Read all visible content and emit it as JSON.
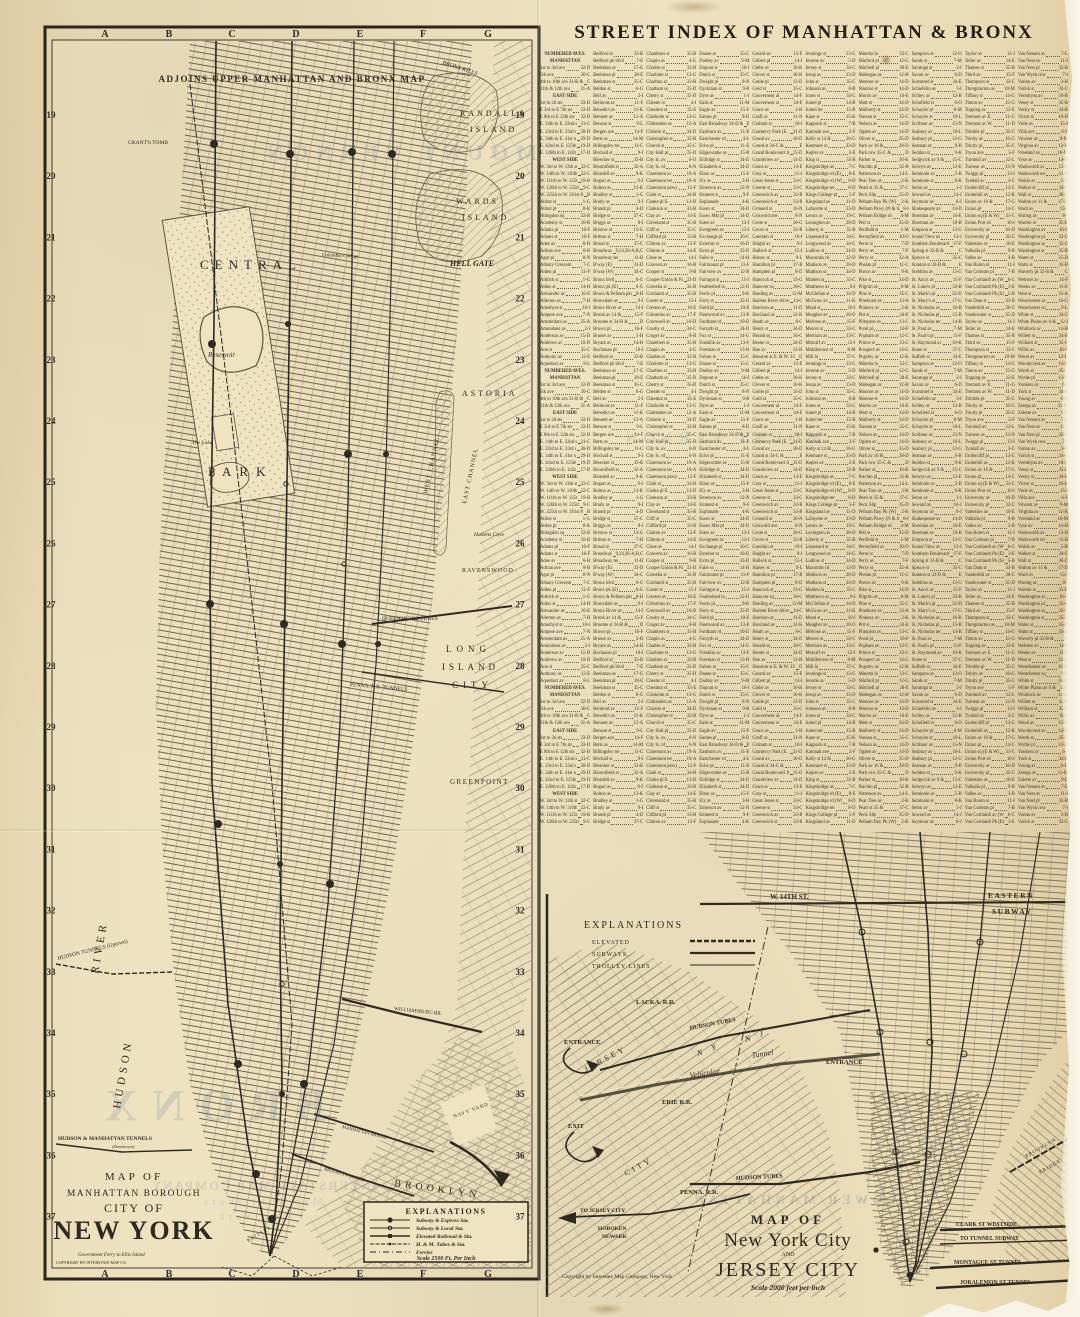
{
  "street_index": {
    "title": "STREET INDEX OF MANHATTAN & BRONX",
    "columns": [
      {
        "entries": [
          "*NUMBERED AVES.",
          "*MANHATTAN",
          "1st to 3rd avs 32-D",
          "5th ave 30-C",
          "4th to 10th avs 31-B & C",
          "11th & 12th avs 31-A",
          "*EAST SIDE",
          "1st to 2d sts 33-D",
          "E 3rd to E 7th sts 33-D",
          "E 8th to E 12th sts 32-D",
          "E. 14th to E. 22nd sts 31-C",
          "E. 23rd to E. 33rd sts 30-D",
          "E. 34th to E. 41st sts 29-D",
          "E. 42nd to E. 125th sts 19-D",
          "E. 126th to E. 142nd sts 17-D",
          "*WEST SIDE",
          "W. 3rd to W. 13th sts 32-C",
          "W. 14th to W. 110th sts 22-C",
          "W. 111th to W. 125th sts 19-B",
          "W. 126th to W. 225th sts 9-C",
          "W. 225th to W. 261st 8-A & B",
          "Abbot st 1-G",
          "Abbot pl 8-K",
          "Abingdon sq 32-B",
          "Academy st 10-B",
          "Adams pl 10-F",
          "Adams st 16-F",
          "Adee av 6-H",
          "Adrian ave 8-B",
          "Agar pl 8-N",
          "Albany Crescent 7-C",
          "Alden pl 11-F",
          "Aldrich st 1-G",
          "Aldus st 14-H",
          "Alexander av 16-E",
          "Allerton av 7-H",
          "Amethyst st 10-I",
          "Ampere ave 7-N",
          "Amsterdam av 25-A",
          "Amundsen av 2-I",
          "Anderson av 15-D",
          "Andrews av 10-D",
          "Ann st 35-C",
          "Anthony av 12-E",
          "Aqueduct av 8-L"
        ]
      },
      {
        "entries": [
          "Bedford st 33-B",
          "Bedford pk blvd 7-E",
          "Beekman av 17-G",
          "Beekman pl 28-E",
          "Beekman st 35-C",
          "Belden st 6-G",
          "Bell av 2-I",
          "Belmont av 11-F",
          "Benedict av 11-K",
          "Bennett av 12-A",
          "Benson st 9-L",
          "Bergen ave 14-F",
          "Betts av 14-M",
          "Billingsley ter 11-C",
          "Birchall st 9-I",
          "Bleecker st 33-B",
          "Bloomfield st 32-A",
          "Blondell av 9-K",
          "Bogart av 9-J",
          "Bolton av 13-K",
          "Bradley st 1-G",
          "Brady av 9-I",
          "Brandt pl 4-D",
          "Bridge st 37-C",
          "Briggs av 8-I",
          "Bristow st 13-G",
          "Britton st 7-H",
          "Broad st 37-C",
          "Broadway 9,24,30-A,B,C",
          "Broadway ter 11-B",
          "B'way (E) 33-D",
          "B'way (W) 34-C",
          "Bronx blvd 6-G",
          "Bronx pk (E) 6-G",
          "Bronx & Pelham pkwy 8-H",
          "Bronxdale av 9-I",
          "Bronx River av 14-I",
          "Brook av 14 & 15-F",
          "Broome st 34-B & D",
          "Brown pl 16-F",
          "Bruner av 3-H",
          "Bryant av 14-H",
          "Buchanan pl 10-I"
        ]
      },
      {
        "entries": [
          "Chambers st 35-B",
          "Chapin av 4-G",
          "Charles st 32-B",
          "Charlotte st 13-G",
          "Charlton st 33-B",
          "Chatham sq 35-D",
          "Cherry st 35-D",
          "Chester st 4-I",
          "Chestnut st 35-E",
          "Chisholm st 13-G",
          "Chittenden av 12-A",
          "Christie st 34-D",
          "Christopher st 32-B",
          "Church st 35-C",
          "City Hall pl 35-D",
          "City Is. av 6-O",
          "City Is. rd 6-N",
          "Claremont av 19-A",
          "Claremont ter 19-A",
          "Claremont pkwy 12-F",
          "Clark st 34-B",
          "Clarke pl E. 13-D",
          "Clarkson st 33-B",
          "Clay av 14-E",
          "Cleveland st 35-B",
          "Cliff st 35-C",
          "Clifford pl 13-B",
          "Clinton av 13-F",
          "Clinton st 34-E",
          "Close av 14-I",
          "Convent av 16-B",
          "Cooper st 9-B",
          "Cooper Union & Park 32-D",
          "Cornelia st 32-B",
          "Cortlandt st 35-B",
          "Coster st 15-I",
          "Creston av 10-E",
          "Crimmins av 17-F",
          "Cromwell av 16-D",
          "Crosby st 34-C",
          "Cruger av 8-H"
        ]
      },
      {
        "entries": [
          "Duane st 35-C",
          "Dudley av 9-M",
          "Dupont st 16-I",
          "Dutch st 35-C",
          "Dwight pl 8-N",
          "Dyckman st 9-B",
          "Dyre av 1-J",
          "Eads st 11-M",
          "Eagle av 15-F",
          "Eames pl 8-D",
          "East Broadway 34-D & E",
          "Eastburn av 11-E",
          "Eastchester rd 4-L",
          "Echo pl 11-E",
          "Edgecombe av 15-B",
          "Eldridge st 34-D",
          "Elizabeth st 34-D",
          "Elton av 15-F",
          "Ely av 3-H",
          "Emerson av 12-N",
          "Emmett st 9-F",
          "Esplanade 4-K",
          "Essex st 34-D",
          "Essex Mkt pl 34-D",
          "Estes av 13-I",
          "Evergreen av 13-I",
          "Exchange pl 36-C",
          "Exterior st 16-D",
          "Extra pl 33-D",
          "Faile st 14-H",
          "Fairmount pl 11-F",
          "Fairview av 12-B",
          "Farragut st 15-J",
          "Featherbed la 12-D",
          "Ferris pl 9-K",
          "Ferry st 35-D",
          "Field pl 10-E",
          "Fleetwood av 13-E",
          "Fordham rd 10-D",
          "Forsyth st 34-D",
          "Fox st 14-G",
          "Franklin av 13-F",
          "Freeman st 13-H",
          "Fulton st 35-C"
        ]
      },
      {
        "entries": [
          "Gerard av 15-E",
          "Gilbert pl 14-I",
          "Glebe av 10-K",
          "Glover st 10-K",
          "Goble pl 13-D",
          "Gold st 35-C",
          "Gouverneur al 14-F",
          "Gouverneur st 34-E",
          "Grace av 1-H",
          "Graff av 11-N",
          "Graham st 10-I",
          "Gramercy Park (E. & W.) 31-D",
          "Grand av 10-D",
          "Grand st 34-C & E",
          "Grand Boulevard 10 & 15-D",
          "Grandview av 14-D",
          "Grant av 13-E",
          "Gray st 11-J",
          "Great Jones st 33-C",
          "Greene st 33-C",
          "Greenwich av 32-B",
          "Greenwich st 33-B",
          "Grinnell st 16-N",
          "Griswold ave 8-N",
          "Grote st 10-G",
          "Grove st 32-B",
          "Guerlain st 10-I",
          "Haight av 9-J",
          "Halleck st 15-I",
          "Halsey st 9-L",
          "Hamilton pl 17-B",
          "Hampden pl 8-D",
          "Hancock st 13-G",
          "Hanover sq 36-C",
          "Harding av 12-M",
          "Harlem River driveway 14-C",
          "Harrison av 11-D",
          "Haviland av 12-K",
          "Heath av 8-C",
          "Henry st 34-D",
          "Herald sq 30-C",
          "Hester st 34-D",
          "Hoe av 13-H",
          "Houston st E. & W. 33-B & D"
        ]
      },
      {
        "entries": [
          "Jennings st 13-G",
          "Jerome av 5-D",
          "Jersey st 33-C",
          "Jesup av 13-D",
          "John st 35-C",
          "Johnson av 8-B",
          "Jones st 33-C",
          "Jumel pl 14-B",
          "Jumel ter 15-B",
          "Kane st 15-K",
          "Kappock st 7-B",
          "Katonah ave 2-F",
          "Kelly st 14 & 16-G",
          "Kenmare st 33-D",
          "Kepler av 2-E",
          "King st 33-B",
          "Kingsbridge av 7-C",
          "Kingsbridge rd (E) 8-E",
          "Kingsbridge rd (W) 8-D",
          "Kingsbridge ter 8-D",
          "Kings College pl 5-F",
          "Kingsland av 11-D",
          "Lafayette st 33-D",
          "Lenox av 19-C",
          "Lexington av 28-D",
          "Liberty st 35-B",
          "Lispenard st 34-C",
          "Longwood av 14-G",
          "Ludlow st 34-D",
          "Macombs rd 12-D",
          "Madison av 28-D",
          "Madison st 34-D",
          "Maiden la 35-C",
          "Matthews av 8-I",
          "McClellan st 14-D",
          "McGraw av 11-K",
          "Mead st 10-I",
          "Meagher av 10-O",
          "Melrose av 15-F",
          "Mercer st 33-C",
          "Merriam av 13-C",
          "Metcalf av 12-I",
          "Middletown rd 8-M",
          "Mill la 37-C"
        ]
      },
      {
        "entries": [
          "Minetta la 33-C",
          "Minford pl 12-G",
          "Mitchell pl 28-E",
          "Mohegan av 12-H",
          "Monroe av 14-D",
          "Monroe st 34-D",
          "Morris av 16-E",
          "Mott st 34-D",
          "Mulberry st 34-D",
          "Nassau st 35-C",
          "Nelson av 14-D",
          "Ogden av 14-D",
          "Oliver st 35-D",
          "Park av 16 & 28-D",
          "Park row 35-C & D",
          "Parker st 10-K",
          "Patchin pl 32-B",
          "Patterson av 14-L",
          "Pear Tree av 2-K",
          "Pearl st 35 & 37-C",
          "Peck Slip 35-D",
          "Pelham Bay Pk (W) 2-K",
          "Pelham Pkwy (N & S) 8-I",
          "Pelham Bridge rd 4-M",
          "Pell st 35-D",
          "Penfield st 1-M",
          "Pennyfield av 10-O",
          "Perot st 7-D",
          "Perry av 7-F",
          "Perry st 32-A",
          "Phelan pl 11-C",
          "Pierce av 9-K",
          "Pike st 34-D",
          "Pilgrim av 8-M",
          "Pine st 35-C",
          "Pinehurst av 13-A",
          "Pinkney av 2-K",
          "Pitt st 34-E",
          "Plimpton av 13-C",
          "Pond pl 10-F",
          "Popham av 12-C",
          "Prince st 33-C",
          "Prospect av 14-G",
          "Pugsley av 12-K"
        ]
      },
      {
        "entries": [
          "Sampson av 12-O",
          "Sands st 7-M",
          "Saratoga st 2-I",
          "Saxon av 6-D",
          "Scammel st 34-E",
          "Schiefelin av 3-I",
          "Schley av 12-B",
          "Schofield st 6-O",
          "Schuyler pl 8-M",
          "Schuyler st 10-L",
          "Scribner av 15-N",
          "Seabury av 10-L",
          "Seabury pl 12-G",
          "Seaman av 9-B",
          "Seddon st 9-K",
          "Sedgwick av 9 & 15-C",
          "Selwyn av 12-E",
          "Seminole av 5-B",
          "Seminole st 8-K",
          "Seton av 1-J",
          "Seward av 14-J",
          "Seymour av 6-J",
          "Shakespeare av 14-D",
          "Sheridan av 16-E",
          "Sherman av 10-B",
          "Simpson st 13-G",
          "Sound View av 13-J",
          "Southern Boulevard 10 & 17-F",
          "Spring st 33-B & C",
          "Spruce st 35-C",
          "Stanton st 33-D & E",
          "Stebbins av 13-G",
          "St. Ann's av 15-F",
          "St. Luke's pl 33-B",
          "St. Mark's pl 32-D",
          "St. Mary's st 17-G",
          "St. Nicholas av 16-B",
          "St. Nicholas pl 15-B",
          "St. Nicholas ter 14-B",
          "St. Paul av 7-M",
          "St. Paul's pl 13-F",
          "St. Raymond av 10-K",
          "Stone st 37-C",
          "Suffolk st 34-E"
        ]
      },
      {
        "entries": [
          "Taylor av 11-J",
          "Teller av 14-E",
          "Thames st 35-B",
          "Third av 15-F",
          "Thompson st 33-C",
          "Throgmorton av 10-M",
          "Tiffany st 14-G",
          "Tinton av 15-G",
          "Topping av 12-E",
          "Tremont av E. 11-G",
          "Tremont av W. 11-D",
          "Trimble pl 35-C",
          "Trinity av 16-G",
          "Trinity pl 35-C",
          "Tryon ave 5-F",
          "Turnbull av 12-L",
          "Turneur av 13-N",
          "Twiggs pl 13-I",
          "Tyndall av 3-C",
          "Undercliff pl 13-C",
          "Underhill av 12-K",
          "Union av 16 & 17-G",
          "Union pl 14-C",
          "Union sq (E & W) 31-C",
          "Union Port rd 10-I",
          "University av 10-D",
          "University pl 32-C",
          "Valentine av 10-E",
          "Valhalla pl 9-B",
          "Valles av 3-B",
          "Van Buren st 11-I",
          "Van Corlears pl 7-B",
          "Van Cortlandt av (W) 6-C",
          "Van Cortlandt Pk (E) 3-E",
          "Van Cortlandt Pk (S) 5-B",
          "Van Dam st 33-B",
          "Vanderbilt av 30-C",
          "Vandewater st 35-D"
        ]
      },
      {
        "entries": [
          "Van Nessen av 7-L",
          "Van Nest av 11-I",
          "Van Nest pl 32-B",
          "Van Wyck row 7-I",
          "Varian av 3-H",
          "Varick st 33-C",
          "Vermilyea av 10-B",
          "Vesey st 35-B",
          "Vestry st 34-B",
          "Victor st 10-H",
          "Viele av 15-I",
          "Villa ave 6-F",
          "Vincent av 9-M",
          "Virginia av 12-K",
          "Vreeland av 10-M",
          "Vyse av 14-H",
          "Wadsworth av 13-B",
          "Wadsworth ter 11-B",
          "Waldo av 5-B",
          "Walker st 34-C",
          "Wall st 36-C",
          "Walton av 11 & 17-D",
          "Ward av 13-J",
          "Waring av 8-I",
          "Warren st 35-B",
          "Washington av 16-F",
          "Washington pl 32-C",
          "Washington sq 32-C",
          "Washington st 35-B",
          "Water st 35-D",
          "Watts st 33-B",
          "Waverly pl 32-B & C",
          "Webster av 14-F",
          "Weeks av 11-E",
          "West st 33-A",
          "Westchester av 16-G",
          "Westchester sq 9-L",
          "White st 34-C",
          "White Plains av 6 & 12-I",
          "Whitlock av 14-H",
          "Willett st 34-E",
          "William st 35-C",
          "Willis av 16-F",
          "Wood av 12-K",
          "Woodycrest av 14-D",
          "Worth st 35-C",
          "Wythe pl 13-D",
          "Yonkers av 6-J",
          "York st 34-B",
          "Young av 6-H",
          "Zerega av 11-M",
          "Zulette av 9-L"
        ]
      }
    ]
  },
  "left_map": {
    "adjoins_note": "ADJOINS UPPER MANHATTAN AND BRONX MAP",
    "grid_letters": [
      "A",
      "B",
      "C",
      "D",
      "E",
      "F",
      "G"
    ],
    "row_numbers": [
      "19",
      "20",
      "21",
      "22",
      "23",
      "24",
      "25",
      "26",
      "27",
      "28",
      "29",
      "30",
      "31",
      "32",
      "33",
      "34",
      "35",
      "36",
      "37"
    ],
    "labels": {
      "grants_tomb": "GRANT'S TOMB",
      "columbia": "Columbia College",
      "central": "CENTRAL",
      "park": "PARK",
      "reservoir": "Reservoir",
      "the_lake": "The Lake",
      "randalls_1": "RANDALLS",
      "randalls_2": "ISLAND",
      "wards_1": "WARDS",
      "wards_2": "ISLAND",
      "hell_gate": "HELL GATE",
      "bronx_kills": "BRONX  KILLS",
      "astoria": "ASTORIA",
      "halletts": "Halletts Cove",
      "ravenswood": "RAVENSWOOD",
      "blackwells": "BLACKWELLS ISLAND",
      "west_channel": "WEST  CHANNEL",
      "east_channel": "EAST  CHANNEL",
      "long": "LONG",
      "island": "ISLAND",
      "city": "CITY",
      "greenpoint": "GREENPOINT",
      "brooklyn": "BROOKLYN",
      "williamsburg_br": "WILLIAMSBURG BR.",
      "manhattan_br": "MANHATTAN BRIDGE",
      "brooklyn_br": "BROOKLYN BRIDGE",
      "queensboro": "QUEENSBORO TUBES",
      "penna_tunnels": "PENNA. R.R. TUNNELS",
      "hudson_tunnels": "HUDSON TUNNELS (Uptown)",
      "hm_tunnels": "HUDSON & MANHATTAN TUNNELS",
      "hm_tunnels2": "(Downtown)",
      "hudson": "HUDSON",
      "river": "RIVER",
      "battery": "BATTERY",
      "govt_ferry": "Government Ferry to Ellis Island",
      "navy_yard": "NAVY YARD"
    },
    "subway_note": [
      "SUBWAY",
      "FROM CITY HALL",
      "NEW YORK TO",
      "CONEY ISLAND"
    ],
    "title": [
      "MAP OF",
      "MANHATTAN BOROUGH",
      "CITY OF",
      "NEW YORK"
    ],
    "copyright": "COPYRIGHT      BY INTERSTATE MAP CO.",
    "legend": {
      "title": "EXPLANATIONS",
      "items": [
        "Subway & Express Sta.",
        "Subway & Local Sta.",
        "Elevated Railroad & Sta.",
        "H. & M. Tubes & Sta.",
        "Ferries"
      ],
      "scale": "Scale 2500 Ft. Per Inch"
    }
  },
  "jc_map": {
    "legend": {
      "title": "EXPLANATIONS",
      "items": [
        "ELEVATED",
        "SUBWAYS",
        "TROLLEY LINES"
      ]
    },
    "labels": {
      "lacka": "LACKA. R.R.",
      "erie": "ERIE R.R.",
      "penna": "PENNA. R.R.",
      "hudson_tubes_u": "HUDSON TUBES",
      "hudson_tubes_l": "HUDSON TUBES",
      "vehicular": "Vehicular",
      "tunnel": "Tunnel",
      "ny": "N  Y",
      "nj": "N  J",
      "entrance_l": "ENTRANCE",
      "entrance_r": "ENTRANCE",
      "exit": "EXIT",
      "to_jersey": "TO JERSEY CITY",
      "hoboken": "HOBOKEN",
      "newark": "NEWARK",
      "jersey": "JERSEY",
      "city": "CITY",
      "st14": "W.  14TH  ST.",
      "eastern": "EASTERN",
      "subway": "SUBWAY",
      "brooklyn_br1": "BROOKLYN",
      "brooklyn_br2": "BRIDGE",
      "clark": "CLARK  ST  WESTSIDE",
      "to_tunnel": "TO  TUNNEL   SUBWAY",
      "montague": "MONTAGUE  ST  TUNNEL",
      "joralemon": "JORALEMON  ST  TUNNEL"
    },
    "title": [
      "MAP OF",
      "New York City",
      "AND",
      "JERSEY CITY"
    ],
    "scale": "Scale 2000 feet per inch",
    "copyright": "Copyright by Interstate Map Company, New York"
  },
  "bleed_through": {
    "mount_vernon": "MOUNT VERNON",
    "bronx": "BRONX",
    "company": "INTERSTATE MAP COMPANY",
    "publishers": "Map Publishers",
    "new_york": "New York",
    "lower_manhattan": "LOWER MANHATTAN"
  },
  "colors": {
    "paper": "#f0e4c4",
    "ink": "#2f2a20",
    "ink_mid": "#57503f",
    "bleed": "#7d949e"
  }
}
